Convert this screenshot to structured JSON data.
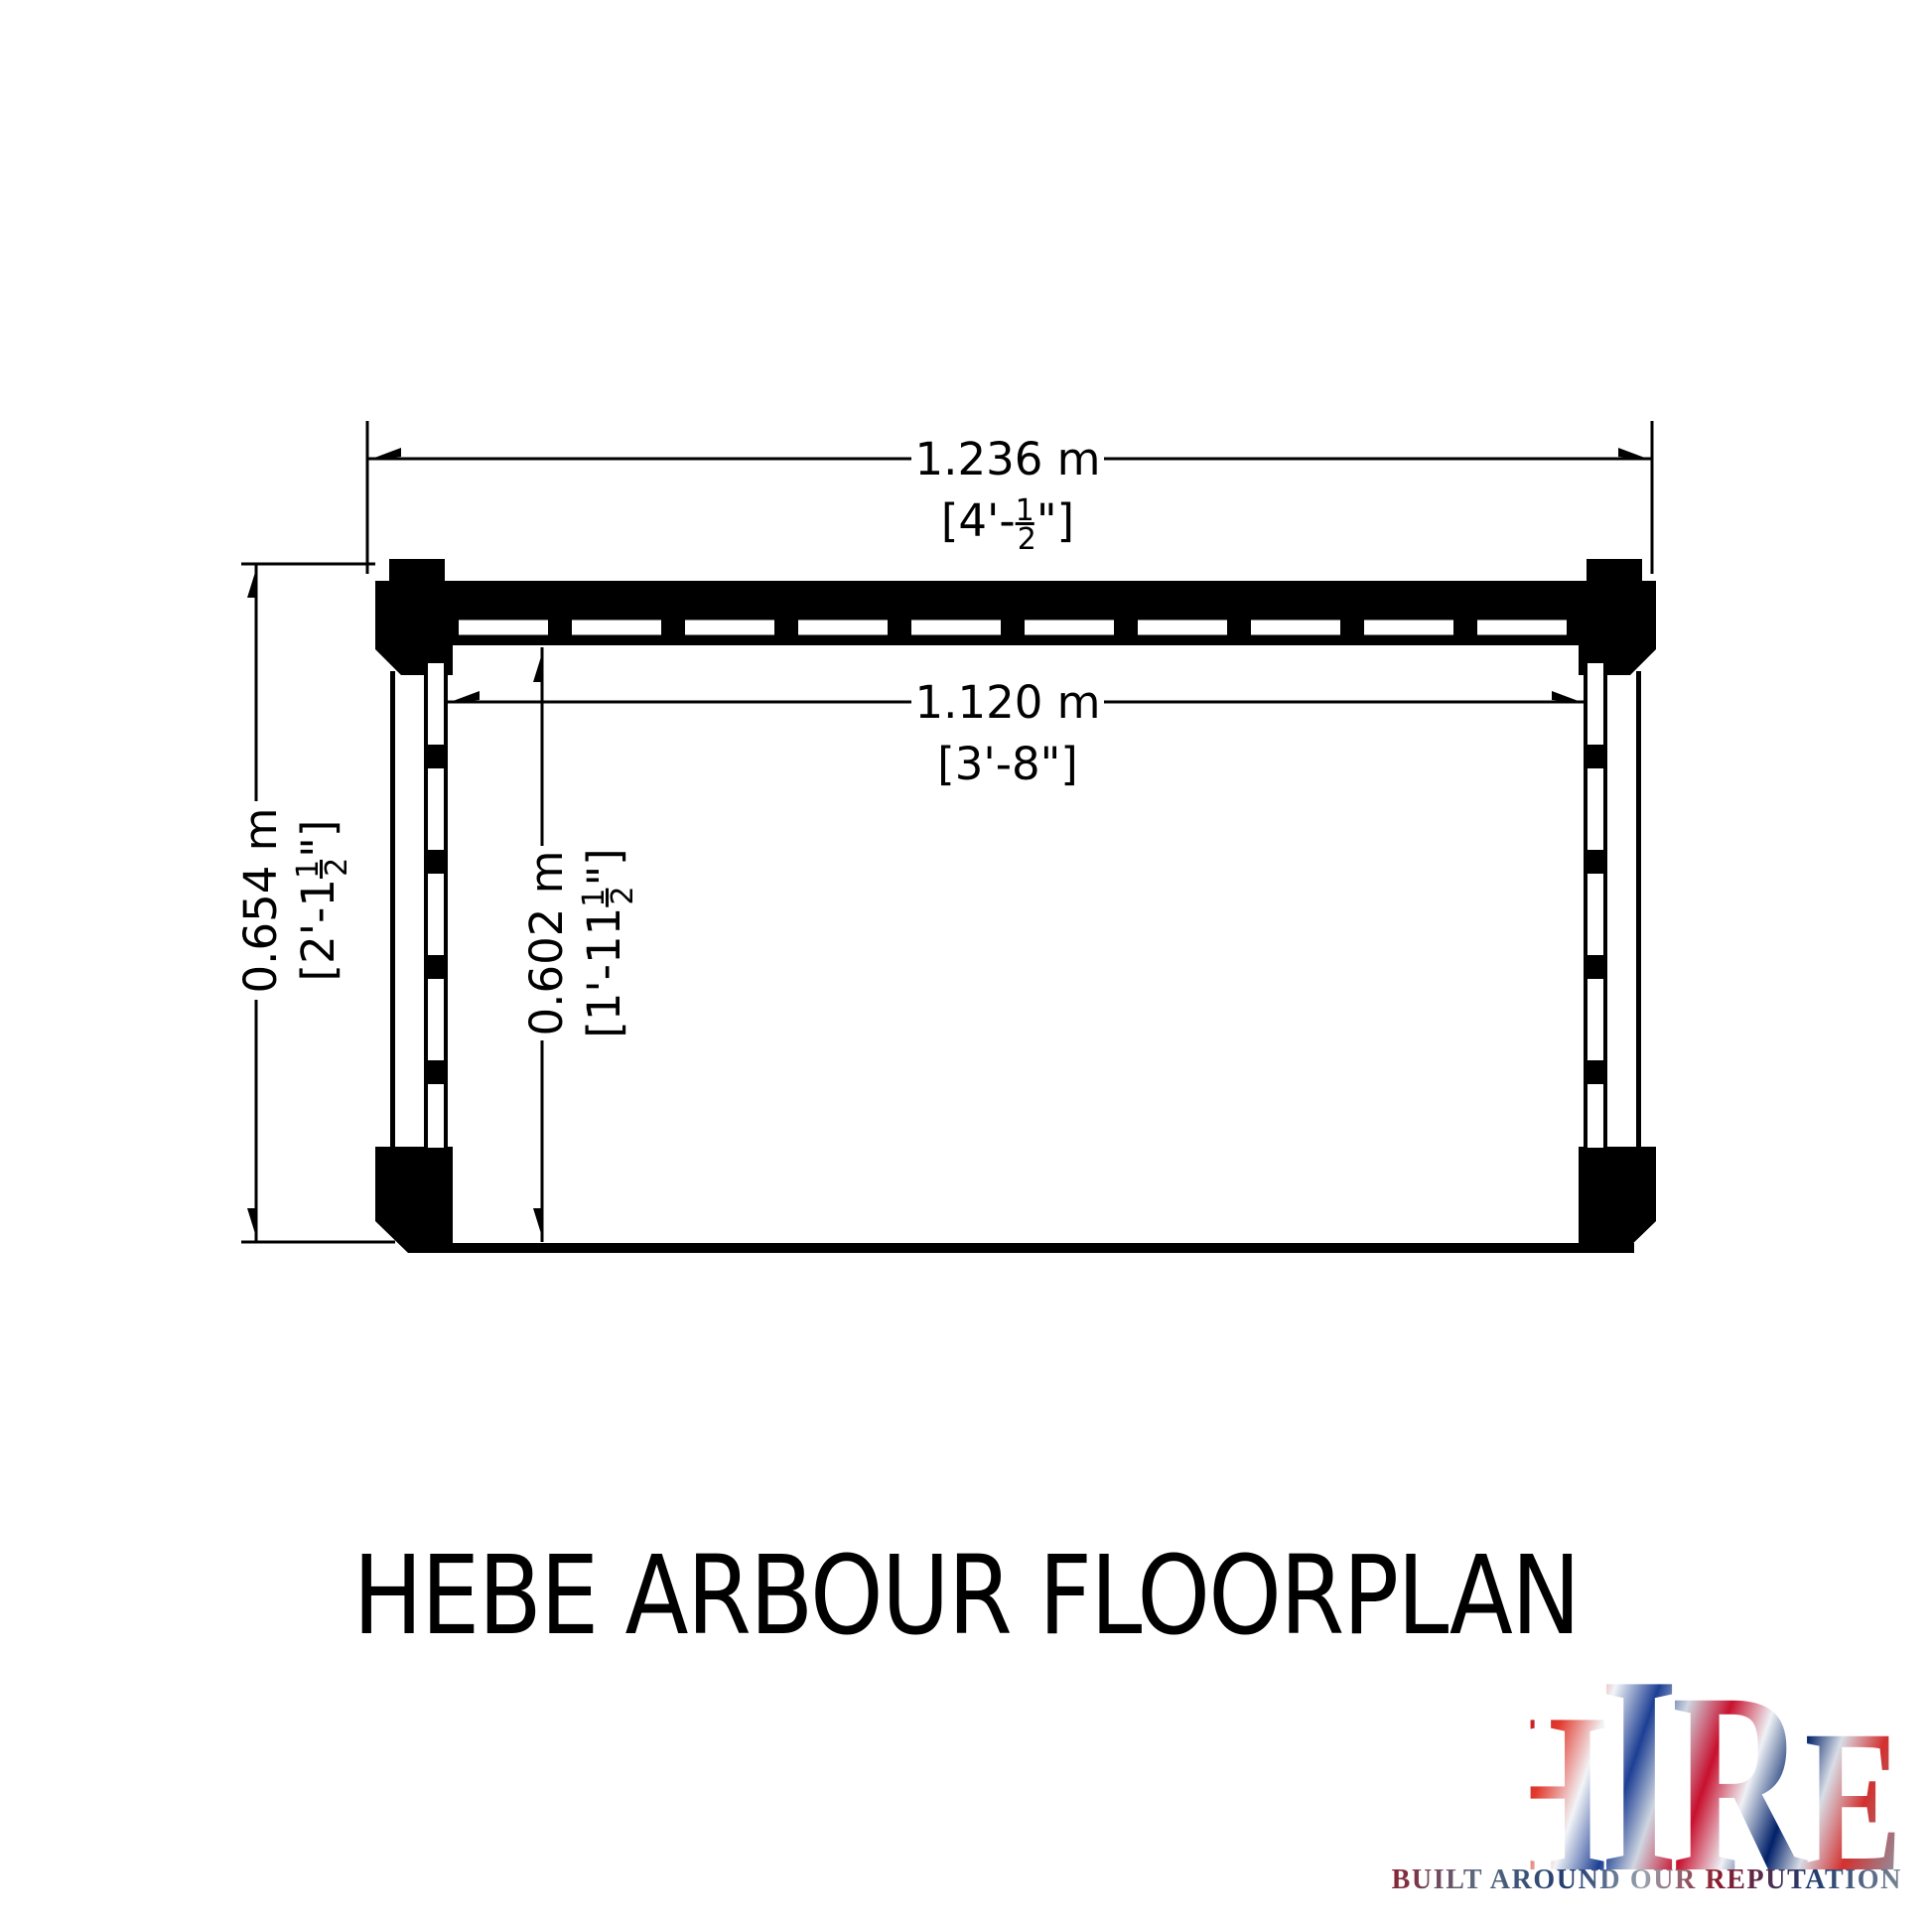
{
  "title": "HEBE ARBOUR FLOORPLAN",
  "plan": {
    "dims": {
      "outer_width": {
        "metric": "1.236 m",
        "imp_prefix": "[4'-",
        "frac_num": "1",
        "frac_den": "2",
        "imp_suffix": "\"]"
      },
      "inner_width": {
        "metric": "1.120 m",
        "imperial": "[3'-8\"]"
      },
      "outer_depth": {
        "metric": "0.654 m",
        "imp_prefix": "[2'-1",
        "frac_num": "1",
        "frac_den": "2",
        "imp_suffix": "\"]"
      },
      "inner_depth": {
        "metric": "0.602 m",
        "imp_prefix": "[1'-11",
        "frac_num": "1",
        "frac_den": "2",
        "imp_suffix": "\"]"
      }
    }
  },
  "logo": {
    "letters": [
      "S",
      "H",
      "I",
      "R",
      "E"
    ],
    "tagline": "BUILT AROUND OUR REPUTATION"
  },
  "colors": {
    "ink": "#000000",
    "flag_red": "#c8102e",
    "flag_blue": "#012169",
    "flag_silver": "#dfe3ea"
  }
}
